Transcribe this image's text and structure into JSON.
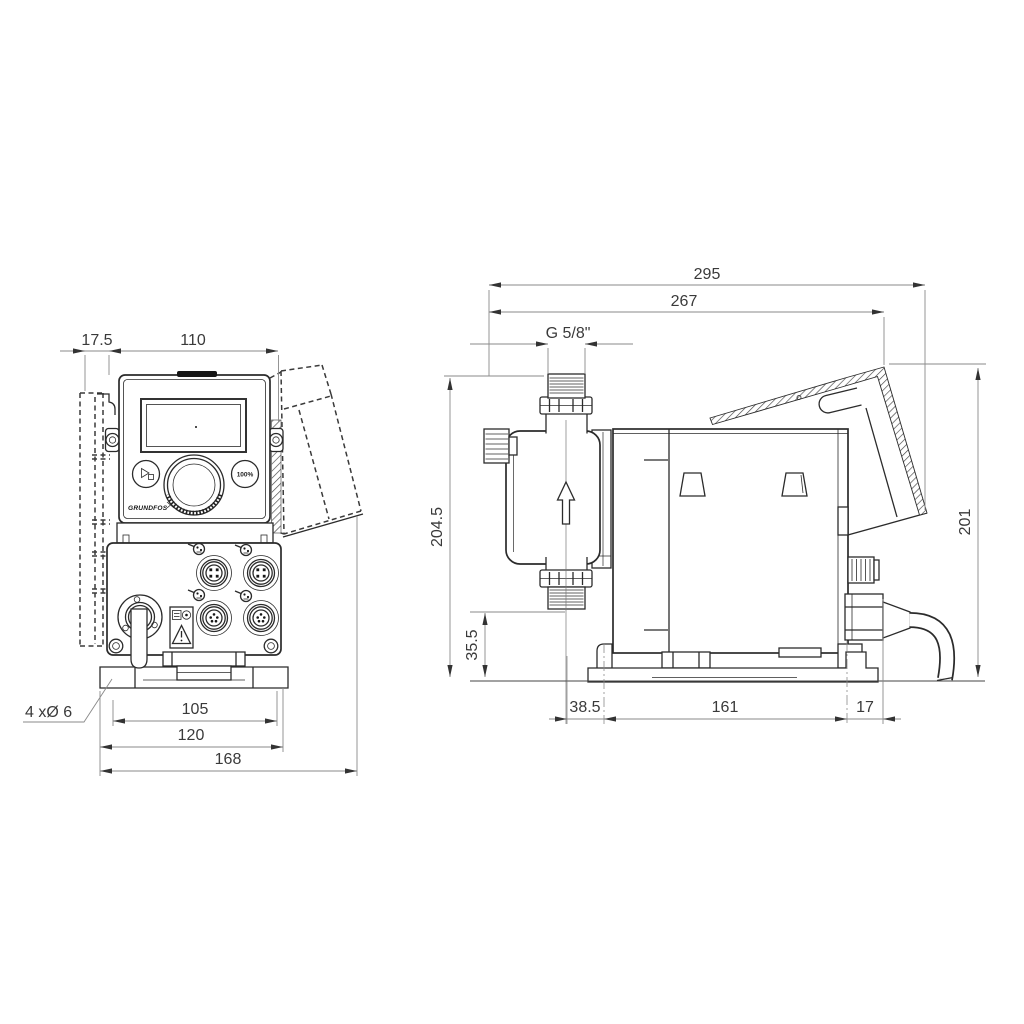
{
  "drawing": {
    "front_view": {
      "dim_offset": "17.5",
      "dim_width": "110",
      "dim_hole_spacing": "105",
      "dim_plate_width": "120",
      "dim_total_width": "168",
      "holes_label": "4 xØ 6",
      "brand": "GRUNDFOS",
      "full_speed_label": "100%"
    },
    "side_view": {
      "dim_total_depth": "295",
      "dim_depth": "267",
      "thread_label": "G 5/8\"",
      "dim_height": "204.5",
      "dim_inlet_height": "35.5",
      "dim_cover_height": "201",
      "dim_front_offset": "38.5",
      "dim_hole_spacing": "161",
      "dim_rear_offset": "17"
    }
  }
}
